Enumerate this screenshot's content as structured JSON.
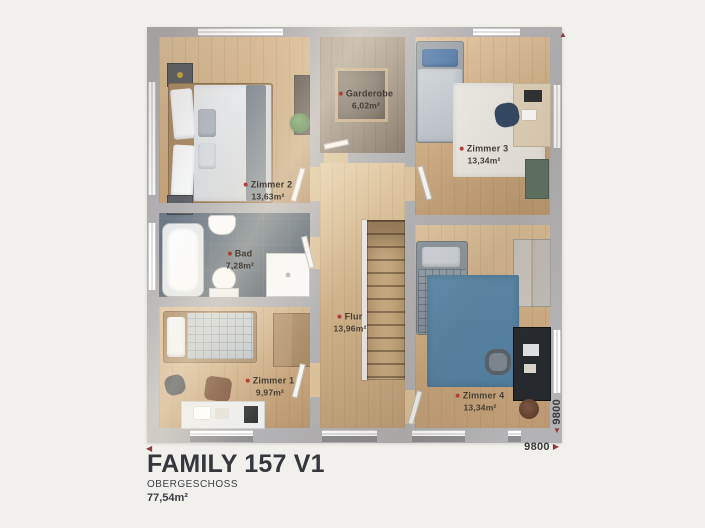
{
  "title_block": {
    "title": "FAMILY 157 V1",
    "subtitle": "OBERGESCHOSS",
    "total_area": "77,54m²"
  },
  "plan": {
    "rooms": {
      "zimmer2": {
        "name": "Zimmer 2",
        "area": "13,63m²"
      },
      "garderobe": {
        "name": "Garderobe",
        "area": "6,02m²"
      },
      "zimmer3": {
        "name": "Zimmer 3",
        "area": "13,34m²"
      },
      "bad": {
        "name": "Bad",
        "area": "7,28m²"
      },
      "flur": {
        "name": "Flur",
        "area": "13,96m²"
      },
      "zimmer1": {
        "name": "Zimmer 1",
        "area": "9,97m²"
      },
      "zimmer4": {
        "name": "Zimmer 4",
        "area": "13,34m²"
      }
    },
    "dimensions": {
      "width": "9800",
      "height": "9800"
    }
  },
  "icons": {
    "arrow_left": "◀",
    "arrow_right": "▶",
    "arrow_up": "▲",
    "arrow_down": "▼"
  },
  "colors": {
    "background": "#f2f0ec",
    "wall": "#b3b2b4",
    "wood_floor": "#ccab82",
    "bath_tile": "#58646f",
    "accent_red": "#903a3c",
    "label_text": "#463e36",
    "title_text": "#34383d"
  }
}
